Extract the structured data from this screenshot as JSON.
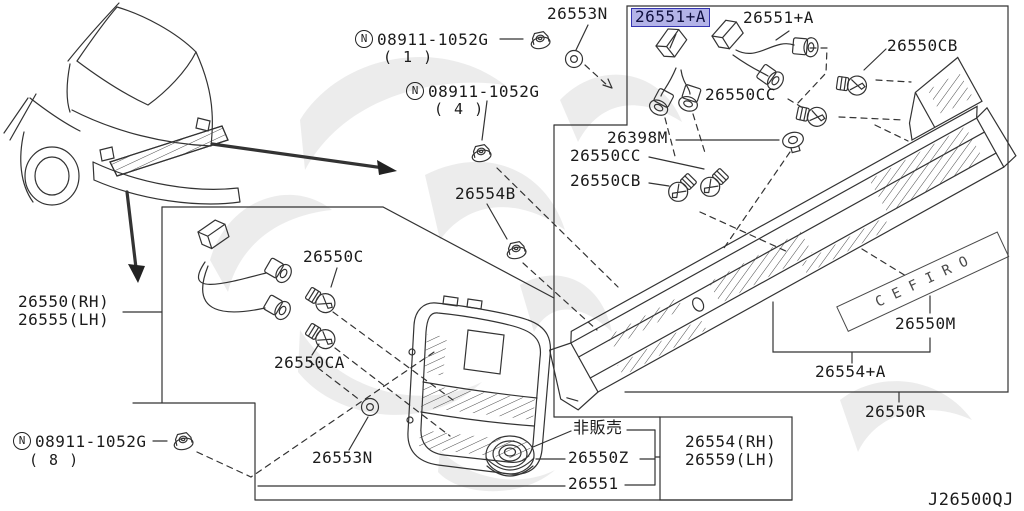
{
  "diagram": {
    "drawing_code": "J26500QJ",
    "highlight": {
      "part": "26551+A",
      "color": "#7474d6"
    },
    "emblem_text": "CEFIRO",
    "not_for_sale": "非販売"
  },
  "labels": {
    "p26553n_top": "26553N",
    "p26551a_hl": "26551+A",
    "p26551a": "26551+A",
    "p26550cb_top": "26550CB",
    "p26550cc_top": "26550CC",
    "p26398m": "26398M",
    "p26550cc2": "26550CC",
    "p26550cb2": "26550CB",
    "p26554b": "26554B",
    "p26550c": "26550C",
    "p26550rh": "26550(RH)",
    "p26555lh": "26555(LH)",
    "p26550ca": "26550CA",
    "p26553n_bottom": "26553N",
    "p26550z": "26550Z",
    "p26551": "26551",
    "p26554rh": "26554(RH)",
    "p26559lh": "26559(LH)",
    "p26550m": "26550M",
    "p26554a": "26554+A",
    "p26550r": "26550R"
  },
  "fasteners": [
    {
      "symbol": "N",
      "code": "08911-1052G",
      "qty": "( 1 )"
    },
    {
      "symbol": "N",
      "code": "08911-1052G",
      "qty": "( 4 )"
    },
    {
      "symbol": "N",
      "code": "08911-1052G",
      "qty": "( 8 )"
    }
  ]
}
